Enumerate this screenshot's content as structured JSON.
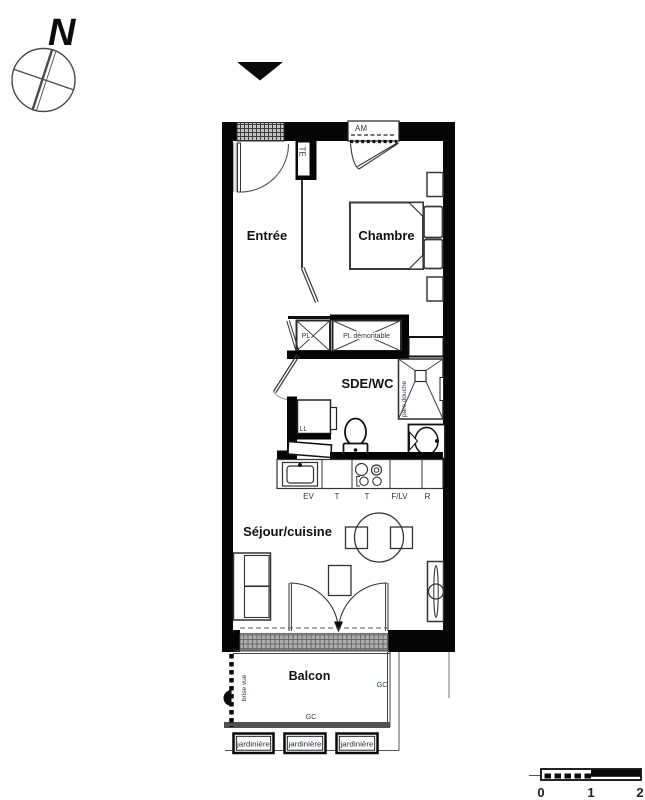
{
  "compass": {
    "north": "N"
  },
  "rooms": {
    "entree": "Entrée",
    "chambre": "Chambre",
    "sde_wc": "SDE/WC",
    "sejour_cuisine": "Séjour/cuisine",
    "balcon": "Balcon"
  },
  "labels": {
    "te": "TE",
    "am": "AM",
    "pl": "PL",
    "pl_demontable": "PL démontable",
    "ll": "LL",
    "pare_douche": "pare douche",
    "brise_vue": "brise vue",
    "gc_side": "GC",
    "gc_bottom": "GC"
  },
  "kitchen": {
    "ev": "EV",
    "t1": "T",
    "t2": "T",
    "f_lv": "F/LV",
    "r": "R"
  },
  "planters": [
    "jardinière",
    "jardinière",
    "jardinière"
  ],
  "scale": {
    "t0": "0",
    "t1": "1",
    "t2": "2"
  },
  "colors": {
    "wall": "#050505",
    "line": "#333333",
    "room_label": "#111111",
    "small_label": "#2e3945",
    "entry_hatch": "#c4c4c4",
    "balcony_hatch": "#adadad"
  }
}
